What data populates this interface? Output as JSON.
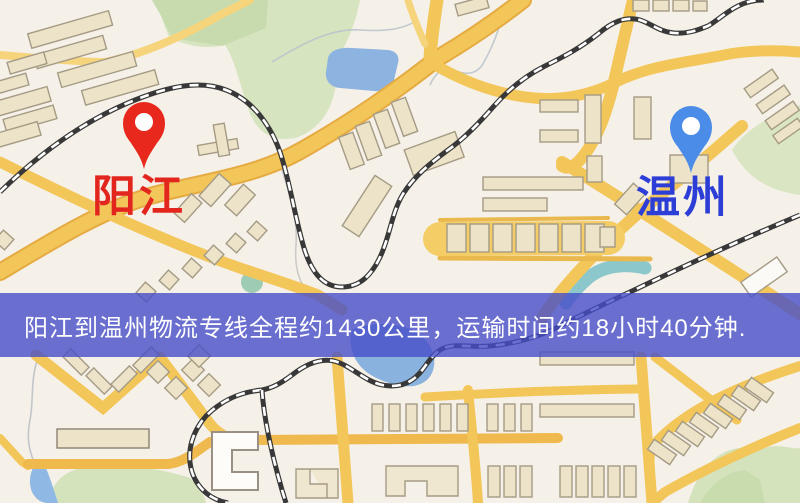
{
  "map": {
    "origin": {
      "name": "阳江",
      "label_color": "#e3261d",
      "pin_color": "#e8281c"
    },
    "destination": {
      "name": "温州",
      "label_color": "#2c3ed6",
      "pin_color": "#4a8ce8"
    },
    "banner": {
      "text": "阳江到温州物流专线全程约1430公里，运输时间约18小时40分钟.",
      "route_distance": "约1430公里",
      "transport_time": "约18小时40分钟",
      "bg_color": "rgba(70,78,200,0.8)",
      "text_color": "#ffffff"
    },
    "style_colors": {
      "background": "#f5f0e8",
      "road": "#f3c659",
      "road_casing": "#e5ab42",
      "water": "#8db4e0",
      "green": "#d7e4c0",
      "railway": "#383838",
      "building": "#ece3c8"
    }
  }
}
